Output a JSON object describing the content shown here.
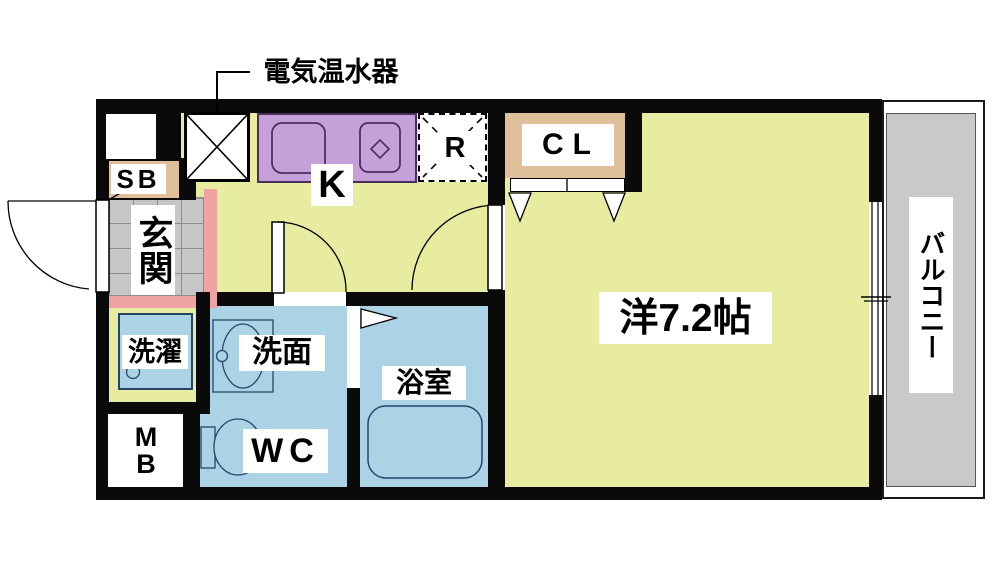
{
  "title": "1K apartment floor plan",
  "annotation": {
    "water_heater": "電気温水器"
  },
  "labels": {
    "kitchen": "K",
    "fridge": "R",
    "closet": "CL",
    "main_room": "洋7.2帖",
    "balcony": "バルコニー",
    "entrance": "玄関",
    "shoe_box": "SB",
    "laundry": "洗濯",
    "washroom": "洗面",
    "wc": "WC",
    "bathroom": "浴室",
    "meter_box_lines": [
      "M",
      "B"
    ]
  },
  "palette": {
    "room_yellow": "#e7eca1",
    "wet_blue": "#abd3e5",
    "counter_purple": "#c6a0d8",
    "closet_tan": "#e0c09a",
    "step_pink": "#f0a3a3",
    "tile_gray": "#c6c6c6",
    "balcony_gray": "#c9c9c9",
    "wall_black": "#0a0a0a",
    "fixture_outline_blue": "#27456b",
    "fixture_outline_purple": "#4a3060"
  }
}
